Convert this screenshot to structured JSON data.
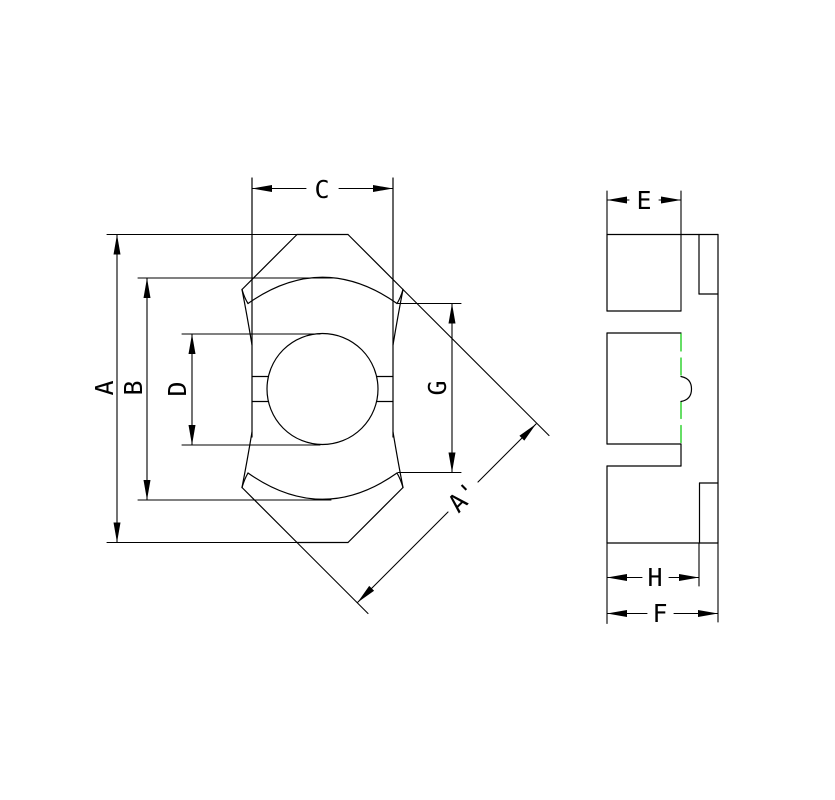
{
  "drawing": {
    "colors": {
      "line": "#000000",
      "centerline_green": "#00c800",
      "background": "#ffffff"
    },
    "dimensions": {
      "A": "A",
      "B": "B",
      "C": "C",
      "D": "D",
      "G": "G",
      "A_prime": "A'",
      "E": "E",
      "H": "H",
      "F": "F"
    }
  }
}
